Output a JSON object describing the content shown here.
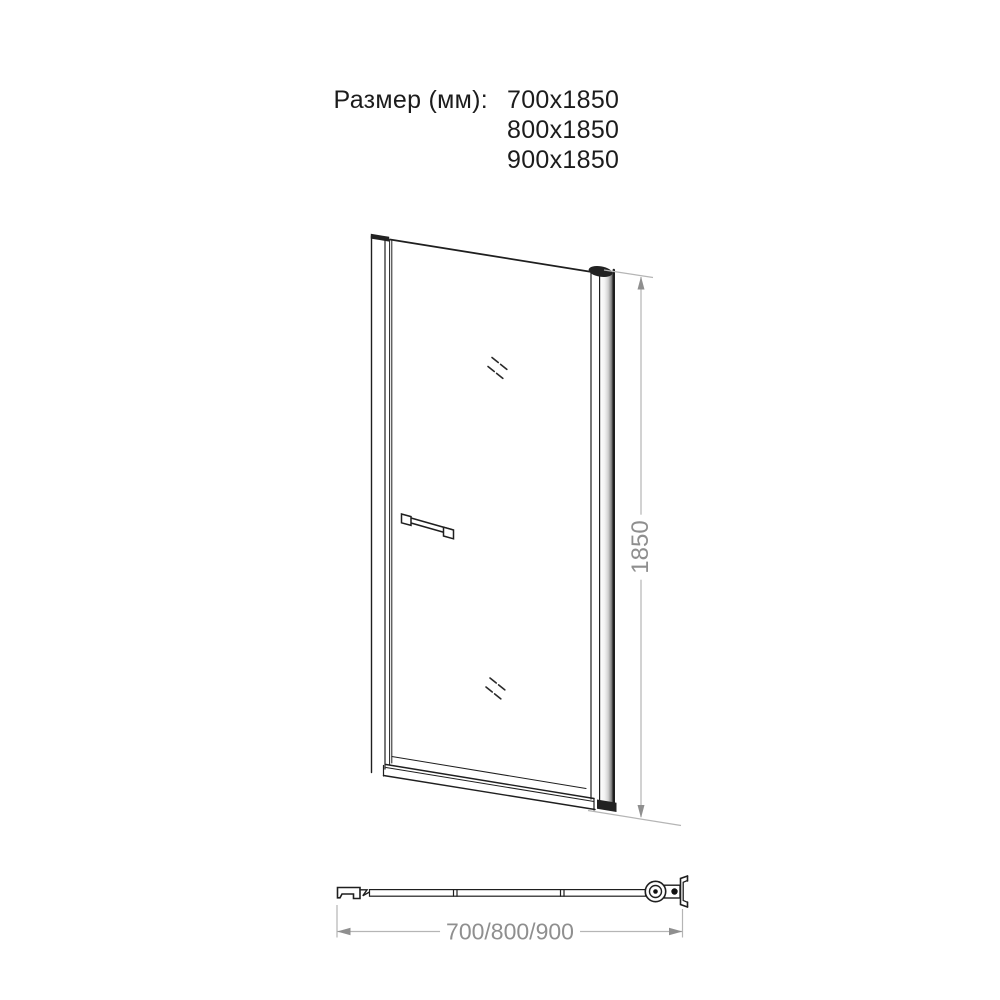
{
  "header": {
    "label": "Размер (мм):",
    "sizes": [
      "700x1850",
      "800x1850",
      "900x1850"
    ]
  },
  "front_view": {
    "height_label": "1850"
  },
  "top_view": {
    "width_label": "700/800/900"
  },
  "colors": {
    "line": "#1f1f1f",
    "dimension_line": "#b5b5b5",
    "dimension_text": "#8f8f8f"
  }
}
